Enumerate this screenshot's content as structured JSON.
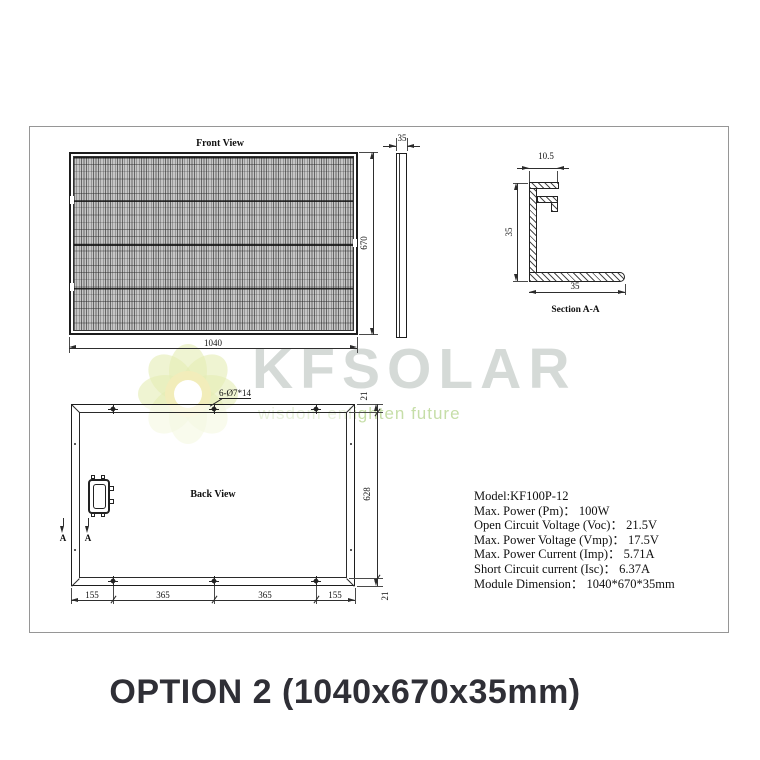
{
  "page": {
    "title": "OPTION 2 (1040x670x35mm)"
  },
  "watermark": {
    "brand": "KFSOLAR",
    "tagline": "wisdom enlighten future"
  },
  "front_view": {
    "label": "Front View",
    "width": "1040",
    "height": "670",
    "thickness": "35"
  },
  "section_view": {
    "label": "Section A-A",
    "lip_width": "10.5",
    "height": "35",
    "base_width": "35"
  },
  "back_view": {
    "label": "Back View",
    "holes_note": "6-Ø7*14",
    "section_letter": "A",
    "bottom_dims": [
      "155",
      "365",
      "365",
      "155"
    ],
    "right_dims": [
      "21",
      "628",
      "21"
    ]
  },
  "specs": {
    "lines": [
      "Model:KF100P-12",
      "Max. Power (Pm)： 100W",
      "Open Circuit Voltage (Voc)： 21.5V",
      "Max. Power Voltage (Vmp)： 17.5V",
      "Max. Power Current (Imp)： 5.71A",
      "Short Circuit current (Isc)： 6.37A",
      "Module Dimension： 1040*670*35mm"
    ]
  }
}
